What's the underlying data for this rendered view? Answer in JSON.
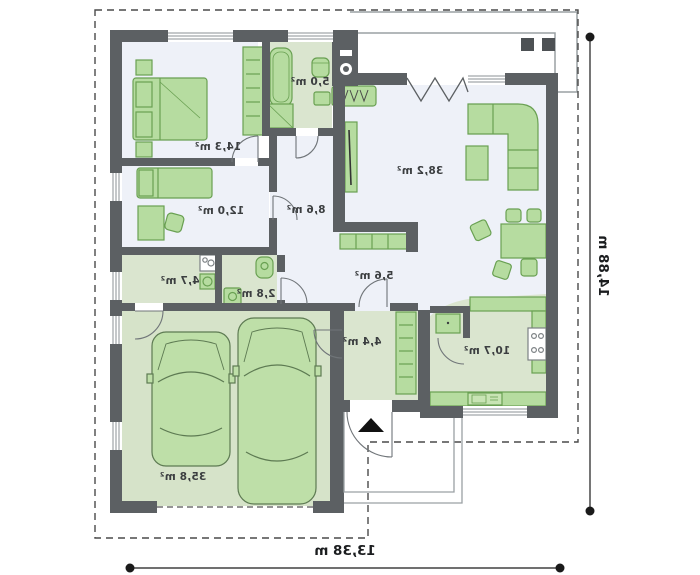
{
  "plan": {
    "type": "house-floor-plan",
    "mirrored_text": true,
    "rooms": [
      {
        "id": "bedroom-1",
        "area_label": "14,3 m²"
      },
      {
        "id": "bathroom",
        "area_label": "5,0 m²"
      },
      {
        "id": "living-room",
        "area_label": "38,2 m²"
      },
      {
        "id": "bedroom-2",
        "area_label": "12,0 m²"
      },
      {
        "id": "hall",
        "area_label": "8,6 m²"
      },
      {
        "id": "utility",
        "area_label": "4,7 m²"
      },
      {
        "id": "wc",
        "area_label": "2,8 m²"
      },
      {
        "id": "corridor",
        "area_label": "5,6 m²"
      },
      {
        "id": "entry",
        "area_label": "4,4 m²"
      },
      {
        "id": "kitchen",
        "area_label": "10,7 m²"
      },
      {
        "id": "garage",
        "area_label": "35,8 m²"
      }
    ],
    "dimensions": {
      "width_label": "13,38 m",
      "height_label": "14,88 m"
    },
    "colors": {
      "wall": "#5c6063",
      "floor_light": "#eef1f8",
      "floor_green": "#dae5cf",
      "floor_garage": "#d6e3c9",
      "furniture_fill": "#b6dca0",
      "furniture_outline": "#69a052",
      "terrace_outline": "#9aa0a3",
      "dark_accent": "#4d5154",
      "dimension_line": "#1a1a1a"
    }
  }
}
